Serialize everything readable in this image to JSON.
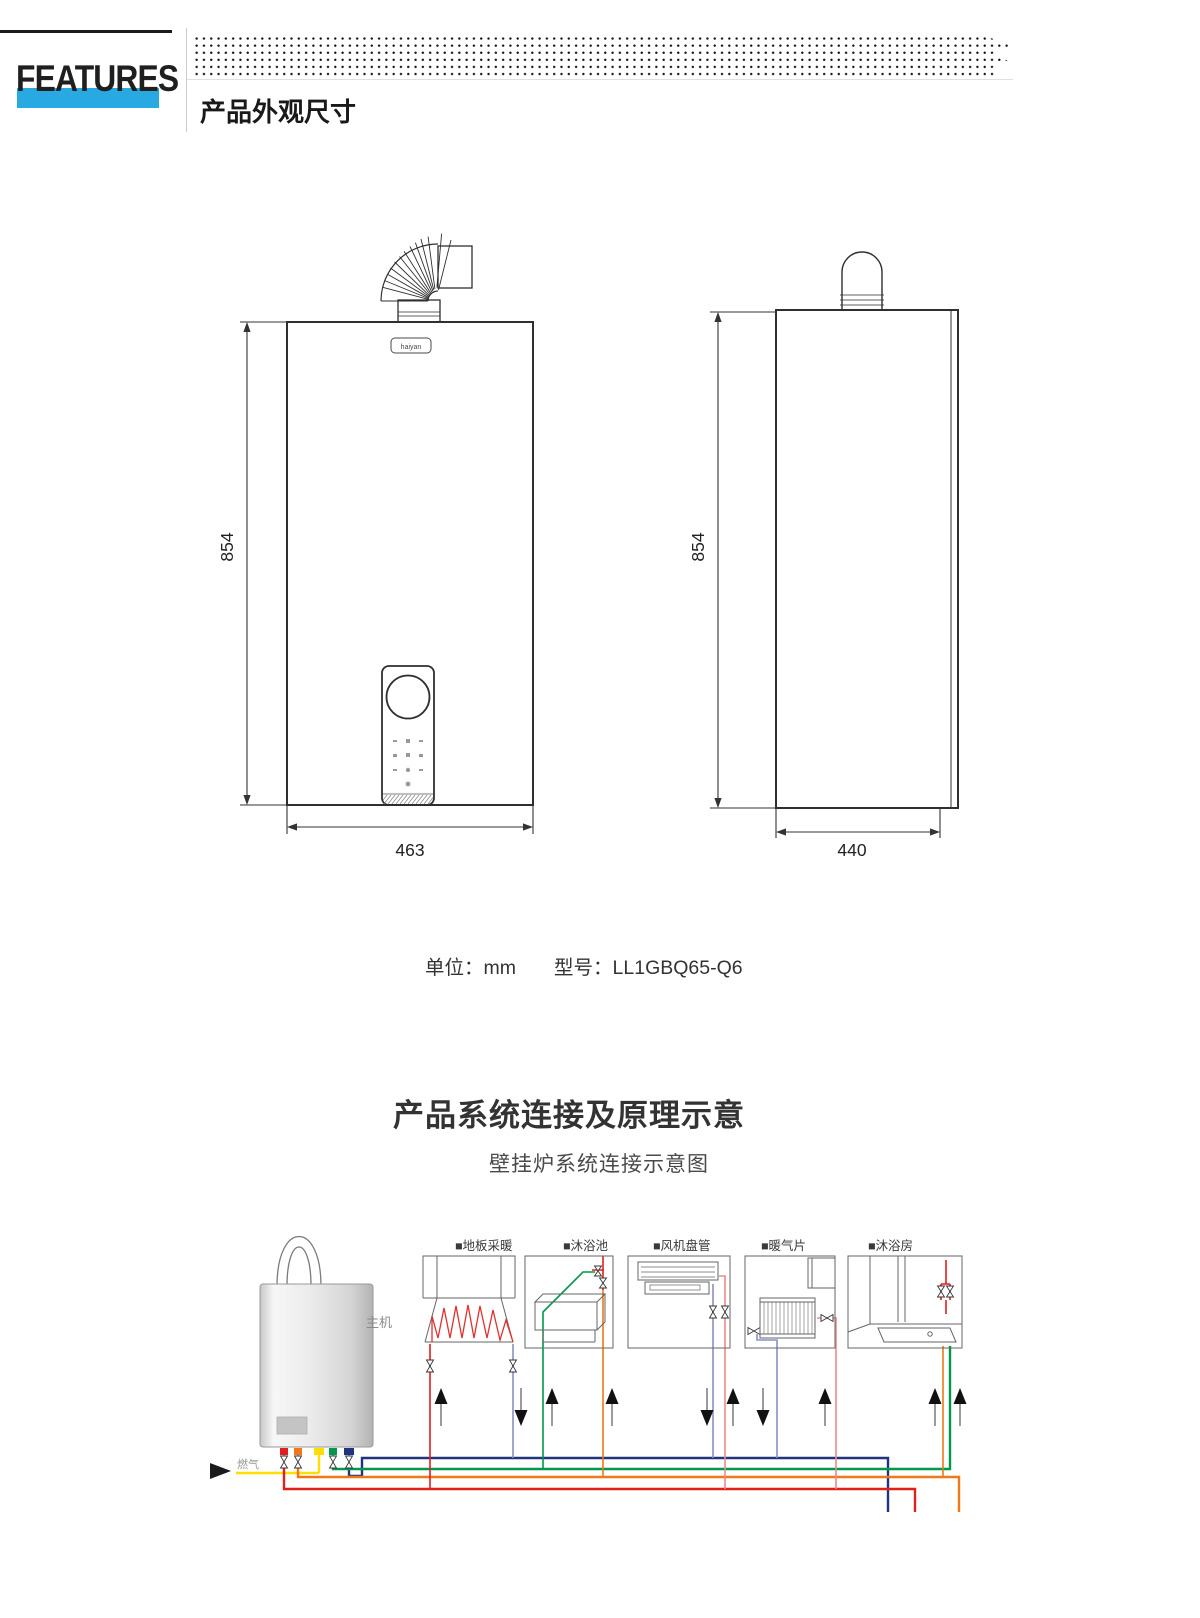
{
  "header": {
    "features_label": "FEATURES",
    "accent_color": "#29a9e1",
    "section1_title": "产品外观尺寸"
  },
  "front_view": {
    "height_dim": "854",
    "width_dim": "463",
    "logo_text": "haiyan"
  },
  "side_view": {
    "height_dim": "854",
    "width_dim": "440"
  },
  "spec_line": {
    "unit_label": "单位：",
    "unit_value": "mm",
    "model_label": "型号：",
    "model_value": "LL1GBQ65-Q6"
  },
  "section2": {
    "title": "产品系统连接及原理示意",
    "subtitle": "壁挂炉系统连接示意图"
  },
  "diagram": {
    "boiler_label": "主机",
    "gas_label": "燃气",
    "appliances": [
      {
        "label": "■地板采暖"
      },
      {
        "label": "■沐浴池"
      },
      {
        "label": "■风机盘管"
      },
      {
        "label": "■暖气片"
      },
      {
        "label": "■沐浴房"
      }
    ],
    "pipe_colors": {
      "heating_supply_red": "#e01f1f",
      "heating_return_navy": "#20337f",
      "return_light": "#8a90c2",
      "dhw_orange": "#f07818",
      "gas_yellow": "#ffdf00",
      "supply_green": "#00984a",
      "pink_branch": "#ef8a8a"
    }
  }
}
